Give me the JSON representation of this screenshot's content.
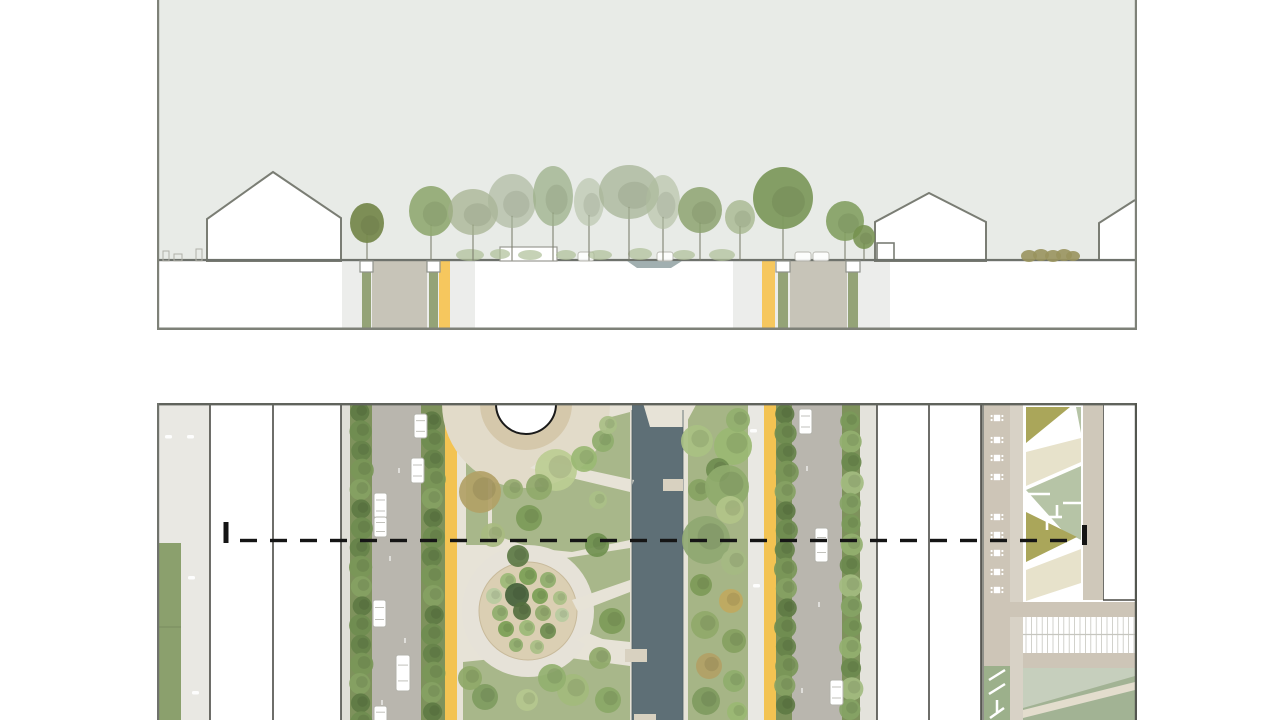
{
  "meta": {
    "title": "Landscape architecture drawing: boulevard cross-section and site plan"
  },
  "colors": {
    "pageBg": "#ffffff",
    "sky": "#e8ebe7",
    "groundLine": "#6e726c",
    "houseOutline": "#7a7d74",
    "houseFill": "#ffffff",
    "sectionBand": "#ecedeb",
    "cutAsphalt": "#c7c4b8",
    "cutGreen": "#94a377",
    "cutYellow": "#f6c75e",
    "pitStroke": "#8f928b",
    "water": "#97a6a7",
    "understory": "#aebf97",
    "hedge": "#99945e",
    "carEdge": "#b3b3ab",
    "planPavement": "#e9e8e3",
    "planLawn": "#8ba06d",
    "treeStrip": "#7e925c",
    "asphalt": "#b9b6ae",
    "yellowLane": "#f3c352",
    "creamBase": "#e7e3d7",
    "plazaMid": "#d5c8ab",
    "plazaOuter": "#e2dbc9",
    "gardenInner": "#dbcfb3",
    "gardenOuter": "#e6e2d8",
    "medianLawn": "#a6b586",
    "canal": "#5e6f76",
    "canalEdge": "#4e5d64",
    "tab": "#d8d1c0",
    "taupe": "#cdc5b7",
    "taupeLight": "#d8d2c6",
    "rill": "#8f9089",
    "bedOlive": "#aaa65a",
    "bedSage": "#b6c4a6",
    "bedCream": "#e7e2cb",
    "boardLine": "#c6c6bf",
    "lawnSE": "#c6cfbd",
    "sageSE": "#a2b394",
    "chevronBed": "#9cb08b",
    "buildingEdge": "#4a4a45",
    "sectionLine": "#151515",
    "borderDark": "#60635c",
    "borderMid": "#7e8178"
  },
  "section": {
    "panel": {
      "x": 157,
      "y": 0,
      "w": 980,
      "h": 330
    },
    "groundY": 260,
    "sidewalkBands": [
      [
        342,
        133
      ],
      [
        733,
        157
      ]
    ],
    "houses": [
      {
        "id": "house-west",
        "points": "207,261 207,219 273,172 341,218 341,261"
      },
      {
        "id": "house-east",
        "points": "875,261 875,222 929,193 986,222 986,261"
      }
    ],
    "annex": [
      877,
      243,
      17,
      18
    ],
    "farEastGable": {
      "poly": "1099,261 1099,223 1135,200 1135,261",
      "line": "1099,261 1099,223 1135,200"
    },
    "roadCuts": [
      {
        "id": "west",
        "asphalt": [
          372,
          55
        ],
        "yellow": [
          439,
          11
        ],
        "pits": [
          [
            360,
            13
          ],
          [
            427,
            13
          ]
        ],
        "greens": [
          [
            362,
            9
          ],
          [
            429,
            9
          ]
        ]
      },
      {
        "id": "east",
        "asphalt": [
          790,
          57
        ],
        "yellow": [
          762,
          13
        ],
        "pits": [
          [
            776,
            14
          ],
          [
            846,
            14
          ]
        ],
        "greens": [
          [
            778,
            10
          ],
          [
            848,
            10
          ]
        ]
      }
    ],
    "waterDip": "627,261 637,268 671,268 682,261",
    "kiosk": [
      500,
      247,
      57,
      14
    ],
    "cars": [
      [
        578,
        252
      ],
      [
        657,
        252
      ],
      [
        795,
        252
      ],
      [
        813,
        252
      ]
    ],
    "understory": [
      [
        470,
        255,
        14,
        6
      ],
      [
        500,
        254,
        10,
        5
      ],
      [
        530,
        255,
        12,
        5
      ],
      [
        566,
        255,
        10,
        5
      ],
      [
        600,
        255,
        12,
        5
      ],
      [
        640,
        254,
        12,
        6
      ],
      [
        684,
        255,
        11,
        5
      ],
      [
        722,
        255,
        13,
        6
      ]
    ],
    "hedge": [
      [
        1029,
        256,
        8,
        6
      ],
      [
        1041,
        255,
        8,
        6
      ],
      [
        1053,
        256,
        8,
        6
      ],
      [
        1064,
        255,
        8,
        6
      ],
      [
        1073,
        256,
        7,
        5
      ]
    ],
    "benchSketches": [
      [
        163,
        251,
        6,
        10
      ],
      [
        174,
        254,
        8,
        7
      ],
      [
        196,
        249,
        6,
        12
      ]
    ],
    "trees": [
      [
        367,
        223,
        17,
        20,
        "#77894e",
        0.95
      ],
      [
        431,
        211,
        22,
        25,
        "#90a871",
        0.9
      ],
      [
        473,
        212,
        25,
        23,
        "#a2af8c",
        0.7
      ],
      [
        512,
        201,
        24,
        27,
        "#a9b699",
        0.65
      ],
      [
        553,
        196,
        20,
        30,
        "#9cb089",
        0.75
      ],
      [
        589,
        202,
        15,
        24,
        "#b3bfa5",
        0.6
      ],
      [
        629,
        192,
        30,
        27,
        "#a3b091",
        0.7
      ],
      [
        663,
        202,
        17,
        27,
        "#afbc9e",
        0.6
      ],
      [
        700,
        210,
        22,
        23,
        "#8da370",
        0.85
      ],
      [
        740,
        217,
        15,
        17,
        "#9eb183",
        0.7
      ],
      [
        783,
        198,
        30,
        31,
        "#7e9a5e",
        0.95
      ],
      [
        845,
        221,
        19,
        20,
        "#83a062",
        0.9
      ],
      [
        864,
        237,
        11,
        12,
        "#74904e",
        0.85
      ]
    ]
  },
  "plan": {
    "panel": {
      "x": 157,
      "y": 403,
      "w": 980,
      "h": 317
    },
    "bands": [
      [
        "west-sidewalk",
        157,
        53,
        "planPavement"
      ],
      [
        "curb-west",
        341,
        9,
        "#dfded7"
      ],
      [
        "tree-strip-a",
        350,
        22,
        "treeStrip"
      ],
      [
        "road-west",
        372,
        49,
        "asphalt"
      ],
      [
        "tree-strip-b",
        421,
        24,
        "treeStrip"
      ],
      [
        "bike-lane-west",
        445,
        12,
        "yellowLane"
      ],
      [
        "median-base",
        457,
        175,
        "creamBase"
      ],
      [
        "canal",
        632,
        51,
        "canal"
      ],
      [
        "canal-edge-path",
        683,
        5,
        "creamBase"
      ],
      [
        "east-lawn-strip",
        688,
        60,
        "medianLawn"
      ],
      [
        "pave-east",
        748,
        16,
        "planPavement"
      ],
      [
        "bike-lane-east",
        764,
        12,
        "yellowLane"
      ],
      [
        "tree-strip-c",
        776,
        16,
        "treeStrip"
      ],
      [
        "road-east",
        792,
        50,
        "asphalt"
      ],
      [
        "tree-strip-d",
        842,
        18,
        "treeStrip"
      ],
      [
        "curb-east",
        860,
        17,
        "#e4e3dc"
      ],
      [
        "rill",
        979,
        5,
        "rill"
      ],
      [
        "promenade",
        984,
        26,
        "taupe"
      ],
      [
        "promenade-light",
        1010,
        13,
        "taupeLight"
      ]
    ],
    "westLawn": {
      "x": 158,
      "w": 23,
      "y": 543,
      "seamY": 627
    },
    "pavementMarks": [
      [
        165,
        435
      ],
      [
        187,
        435
      ],
      [
        188,
        576
      ],
      [
        192,
        691
      ],
      [
        750,
        429
      ],
      [
        753,
        584
      ]
    ],
    "laneSpecks": [
      [
        398,
        468
      ],
      [
        389,
        556
      ],
      [
        404,
        638
      ],
      [
        381,
        700
      ],
      [
        806,
        466
      ],
      [
        818,
        602
      ],
      [
        801,
        688
      ]
    ],
    "buildings": [
      {
        "id": "west-blocks",
        "r": [
          210,
          403,
          131,
          317
        ]
      },
      {
        "id": "east-blocks",
        "r": [
          877,
          403,
          104,
          317
        ]
      },
      {
        "id": "ne-building",
        "r": [
          1103,
          403,
          32,
          197
        ]
      }
    ],
    "buildingEdges": [
      [
        210,
        403,
        720
      ],
      [
        273,
        403,
        720
      ],
      [
        341,
        403,
        720
      ],
      [
        877,
        403,
        720
      ],
      [
        929,
        403,
        720
      ],
      [
        981,
        403,
        720
      ],
      [
        1103,
        403,
        600
      ]
    ],
    "neBuildingBottom": [
      1103,
      600,
      1135,
      600
    ],
    "median": {
      "lawns": [
        "466,445 488,445 488,545 466,545",
        "492,483 540,470 578,436 600,420 630,412 630,540 572,552 532,548 492,534",
        "566,558 630,548 630,642 575,636",
        "463,662 540,654 630,666 630,720 463,720"
      ],
      "canalTopPath": "643,403 697,403 684,427 650,427",
      "paths": [
        "530,468 542,460 634,480 630,492",
        "572,600 630,580 630,592 578,612",
        "576,640 588,633 634,652 628,664"
      ],
      "plaza": {
        "cx": 526,
        "cy": 404,
        "rOuter": 84,
        "rMid": 46,
        "rDome": 30
      },
      "garden": {
        "cx": 528,
        "cy": 611,
        "rOuter": 66,
        "rInner": 49
      },
      "gardenTrees": [
        [
          528,
          576,
          9,
          "#7ba055"
        ],
        [
          508,
          581,
          8,
          "#9cba77"
        ],
        [
          548,
          580,
          8,
          "#8fae6d"
        ],
        [
          494,
          596,
          8,
          "#b8cba0"
        ],
        [
          517,
          595,
          12,
          "#45623b"
        ],
        [
          540,
          596,
          8,
          "#7ba055"
        ],
        [
          560,
          598,
          7,
          "#a9bf85"
        ],
        [
          500,
          613,
          8,
          "#8fae6d"
        ],
        [
          522,
          611,
          9,
          "#55703f"
        ],
        [
          543,
          613,
          8,
          "#90a96a"
        ],
        [
          562,
          615,
          7,
          "#b8cba0"
        ],
        [
          506,
          629,
          8,
          "#7ba055"
        ],
        [
          527,
          628,
          8,
          "#9cba77"
        ],
        [
          548,
          631,
          8,
          "#6f8d50"
        ],
        [
          516,
          645,
          7,
          "#8fae6d"
        ],
        [
          537,
          647,
          7,
          "#a9bf85"
        ]
      ],
      "trees": [
        [
          480,
          492,
          21,
          "#b2a166"
        ],
        [
          493,
          535,
          12,
          "#a8ba80"
        ],
        [
          518,
          556,
          11,
          "#5d7a45"
        ],
        [
          529,
          518,
          13,
          "#7c9a58"
        ],
        [
          513,
          489,
          10,
          "#96ad70"
        ],
        [
          556,
          470,
          21,
          "#bccd92"
        ],
        [
          539,
          487,
          13,
          "#90a96a"
        ],
        [
          584,
          459,
          13,
          "#9ab873"
        ],
        [
          603,
          441,
          11,
          "#8fad6c"
        ],
        [
          608,
          425,
          9,
          "#a9bf85"
        ],
        [
          598,
          500,
          9,
          "#aabf87"
        ],
        [
          597,
          545,
          12,
          "#70904f"
        ],
        [
          612,
          621,
          13,
          "#7d9a58"
        ],
        [
          600,
          658,
          11,
          "#90a96a"
        ],
        [
          573,
          690,
          16,
          "#a3ba7c"
        ],
        [
          608,
          700,
          13,
          "#8aa766"
        ],
        [
          527,
          700,
          11,
          "#b5c78e"
        ],
        [
          485,
          697,
          13,
          "#7f9b60"
        ],
        [
          470,
          678,
          12,
          "#8fa868"
        ],
        [
          552,
          678,
          14,
          "#93b06f"
        ]
      ],
      "eastTrees": [
        [
          697,
          441,
          16,
          "#a9c183"
        ],
        [
          733,
          446,
          19,
          "#9ab873"
        ],
        [
          738,
          420,
          12,
          "#93b06f"
        ],
        [
          718,
          470,
          12,
          "#6f8d50"
        ],
        [
          699,
          490,
          11,
          "#87a363"
        ],
        [
          727,
          487,
          22,
          "#8fab6d"
        ],
        [
          730,
          510,
          14,
          "#b2c489"
        ],
        [
          706,
          540,
          24,
          "#8fa872"
        ],
        [
          734,
          562,
          13,
          "#a5ba83"
        ],
        [
          701,
          585,
          11,
          "#7d9a58"
        ],
        [
          731,
          601,
          12,
          "#c0a95f"
        ],
        [
          705,
          625,
          14,
          "#90a96a"
        ],
        [
          734,
          641,
          12,
          "#86a161"
        ],
        [
          709,
          666,
          13,
          "#b2a166"
        ],
        [
          734,
          681,
          11,
          "#8fae6d"
        ],
        [
          706,
          701,
          14,
          "#7f9b60"
        ],
        [
          737,
          712,
          10,
          "#9ab873"
        ]
      ],
      "canalTabs": [
        [
          663,
          479,
          20,
          12
        ],
        [
          625,
          649,
          22,
          13
        ],
        [
          634,
          714,
          22,
          6
        ]
      ],
      "canalX": [
        632,
        683
      ]
    },
    "streetTreeRows": [
      {
        "id": "row-a",
        "cx": 361,
        "y0": 412,
        "gap": 19.4,
        "n": 17,
        "palette": 0
      },
      {
        "id": "row-b",
        "cx": 433,
        "y0": 421,
        "gap": 19.4,
        "n": 16,
        "palette": 0
      },
      {
        "id": "row-c",
        "cx": 786,
        "y0": 414,
        "gap": 19.4,
        "n": 16,
        "palette": 0
      },
      {
        "id": "row-d",
        "cx": 851,
        "y0": 421,
        "gap": 20.6,
        "n": 15,
        "palette": 1
      }
    ],
    "treePalettes": [
      [
        "#5e7b44",
        "#6f8d50",
        "#66834a",
        "#7a9758",
        "#85a263"
      ],
      [
        "#7b9a5a",
        "#93b06f",
        "#6b8a4e",
        "#a3bc80",
        "#86a465"
      ]
    ],
    "cars": [
      [
        414,
        414,
        13,
        24
      ],
      [
        411,
        458,
        13,
        25
      ],
      [
        374,
        493,
        13,
        25
      ],
      [
        374,
        517,
        13,
        20
      ],
      [
        373,
        600,
        13,
        27
      ],
      [
        396,
        655,
        14,
        36
      ],
      [
        374,
        706,
        13,
        22
      ],
      [
        799,
        409,
        13,
        25
      ],
      [
        815,
        528,
        13,
        34
      ],
      [
        830,
        680,
        13,
        25
      ]
    ],
    "benches": {
      "cx": 997,
      "ys": [
        418,
        440,
        458,
        477,
        517,
        535,
        553,
        572,
        590
      ]
    },
    "beds": {
      "base": [
        1023,
        403,
        60,
        205
      ],
      "plazaBand": [
        1083,
        403,
        20,
        197
      ],
      "plazaBandColor": "#cfc8ba",
      "shapes": [
        {
          "c": "bedOlive",
          "pts": "1026,407 1070,407 1026,443"
        },
        {
          "c": "bedSage",
          "pts": "1076,407 1081,407 1081,433"
        },
        {
          "c": "bedCream",
          "pts": "1026,452 1081,438 1081,462 1026,486"
        },
        {
          "c": "bedSage",
          "pts": "1026,490 1081,466 1081,540 1062,530"
        },
        {
          "c": "bedOlive",
          "pts": "1026,512 1077,537 1026,562"
        },
        {
          "c": "bedCream",
          "pts": "1026,570 1081,549 1081,583 1026,601"
        }
      ],
      "pathMarks": [
        [
          1027,
          494,
          1050,
          494
        ],
        [
          1063,
          503,
          1081,
          503
        ],
        [
          1057,
          505,
          1057,
          517
        ],
        [
          1047,
          517,
          1062,
          517
        ],
        [
          1047,
          519,
          1047,
          530
        ]
      ]
    },
    "eastBlocks": {
      "taupeBand": [
        987,
        602,
        148,
        15
      ],
      "boardwalk": [
        1023,
        617,
        112,
        36
      ],
      "taupePath": [
        1023,
        653,
        112,
        15
      ],
      "lawnSE": [
        1023,
        668,
        112,
        52
      ],
      "sagePoly": "1023,708 1135,676 1135,720 1023,720",
      "creamDiag": "1023,710 1135,682 1135,690 1023,718",
      "chevronBed": [
        984,
        666,
        26,
        54
      ],
      "chevrons": [
        [
          989,
          680,
          1005,
          670
        ],
        [
          989,
          694,
          1005,
          684
        ],
        [
          997,
          700,
          997,
          712
        ],
        [
          990,
          718,
          1004,
          708
        ]
      ]
    },
    "sectionLine": {
      "y": 538.8,
      "h": 3.4,
      "x1": 240,
      "x2": 1076,
      "dash": 17,
      "gap": 13,
      "leftBar": [
        223.5,
        522,
        5,
        21
      ],
      "rightBar": [
        1082,
        525,
        5,
        20
      ]
    }
  }
}
